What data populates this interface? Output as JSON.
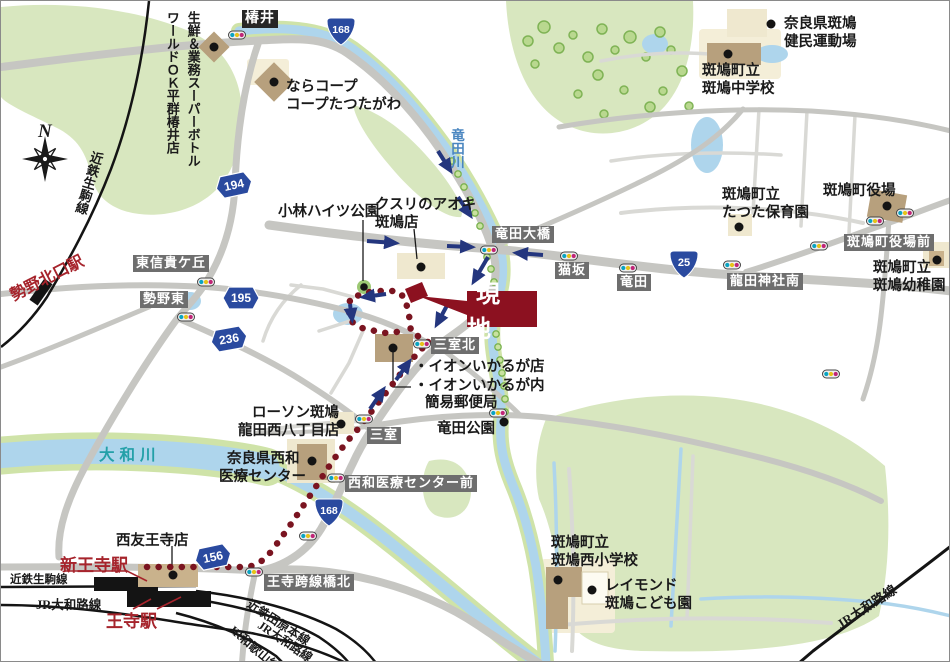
{
  "colors": {
    "site_red": "#8c1120",
    "route_dot_red": "#7a1420",
    "arrow_navy": "#24367e",
    "shield_blue": "#2a4a9f",
    "station_red": "#a6242c",
    "river_blue": "#aed5ec",
    "riverbank_green": "#cfe3a8",
    "area_green": "#d8e7bf",
    "road_gray": "#c6c6c2",
    "building_tan": "#b7a07d"
  },
  "compass": {
    "north": "N"
  },
  "site": {
    "label": "現地"
  },
  "rivers": {
    "tatsutagawa": "竜田川",
    "yamatogawa": "大和川"
  },
  "route_shields": {
    "national_168_north": "168",
    "national_168_south": "168",
    "national_25": "25",
    "pref_194": "194",
    "pref_195": "195",
    "pref_236": "236",
    "pref_156": "156"
  },
  "intersections": {
    "tsubai": "椿井",
    "tatsuta_ohashi": "竜田大橋",
    "nekosaka": "猫坂",
    "tatsuta": "竜田",
    "tatsuta_jinja_minami": "龍田神社南",
    "ikaruga_yakuba_mae": "斑鳩町役場前",
    "higashi_shigigaoka": "東信貴ケ丘",
    "seya_higashi": "勢野東",
    "mimuro_kita": "三室北",
    "mimuro": "三室",
    "seiwa_iryo_center_mae": "西和医療センター前",
    "oji_kosenkyo_kita": "王寺跨線橋北"
  },
  "stations": {
    "seya_kitaguchi": "勢野北口駅",
    "shin_oji": "新王寺駅",
    "oji": "王寺駅"
  },
  "railways": {
    "kintetsu_ikoma_nw": "近鉄生駒線",
    "kintetsu_ikoma_sw": "近鉄生駒線",
    "jr_yamatoji_sw": "JR大和路線",
    "kintetsu_tawaramoto": "近鉄田原本線",
    "jr_yamatoji_mid": "JR大和路線",
    "jr_wakayama": "JR和歌山線",
    "jr_yamatoji_se": "JR大和路線"
  },
  "pois": {
    "seisen_super": {
      "line1": "生鮮＆業務スーパーボトル",
      "line2": "ワールドＯＫ平群椿井店"
    },
    "nara_coop": {
      "line1": "ならコープ",
      "line2": "コープたつたがわ"
    },
    "kenmin_undojo": {
      "line1": "奈良県斑鳩",
      "line2": "健民運動場"
    },
    "ikaruga_chugakko": {
      "line1": "斑鳩町立",
      "line2": "斑鳩中学校"
    },
    "ikaruga_yakuba": {
      "line1": "斑鳩町役場"
    },
    "tatsuta_hoikuen": {
      "line1": "斑鳩町立",
      "line2": "たつた保育園"
    },
    "ikaruga_yochien": {
      "line1": "斑鳩町立",
      "line2": "斑鳩幼稚園"
    },
    "kusuri_aoki": {
      "line1": "クスリのアオキ",
      "line2": "斑鳩店"
    },
    "kobayashi_heights_park": {
      "line1": "小林ハイツ公園"
    },
    "aeon": {
      "line1": "・イオンいかるが店",
      "line2": "・イオンいかるが内",
      "line3": "簡易郵便局"
    },
    "tatsuta_koen": {
      "line1": "竜田公園"
    },
    "lawson": {
      "line1": "ローソン斑鳩",
      "line2": "龍田西八丁目店"
    },
    "seiwa_iryo_center": {
      "line1": "奈良県西和",
      "line2": "医療センター"
    },
    "seiyu_oji": {
      "line1": "西友王寺店"
    },
    "ikaruga_nishi_shogakko": {
      "line1": "斑鳩町立",
      "line2": "斑鳩西小学校"
    },
    "raymond_kodomoen": {
      "line1": "レイモンド",
      "line2": "斑鳩こども園"
    }
  }
}
